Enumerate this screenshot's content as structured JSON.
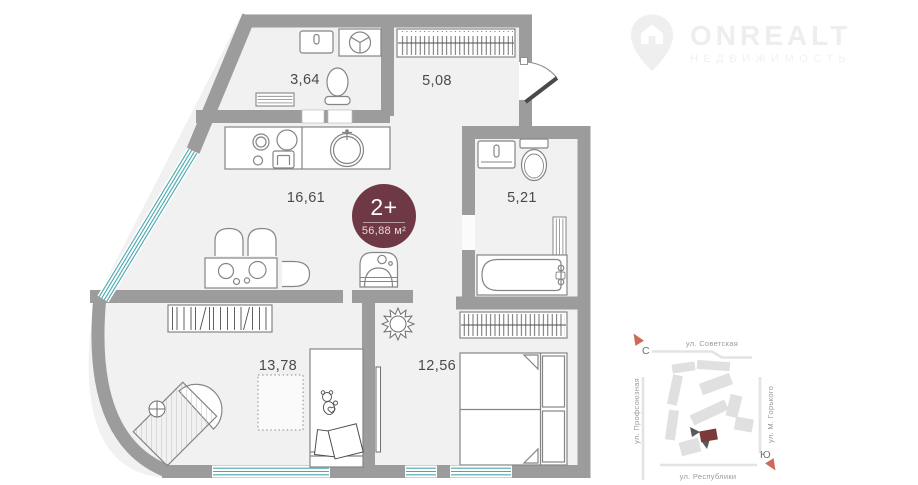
{
  "logo": {
    "title": "ONREALT",
    "subtitle": "НЕДВИЖИМОСТЬ",
    "icon": "house-pin-icon"
  },
  "plan": {
    "badge": {
      "rooms": "2+",
      "total_area": "56,88 м²"
    },
    "rooms": [
      {
        "id": "bathroom-small",
        "area": "3,64"
      },
      {
        "id": "hallway",
        "area": "5,08"
      },
      {
        "id": "kitchen-living",
        "area": "16,61"
      },
      {
        "id": "bathroom",
        "area": "5,21"
      },
      {
        "id": "kids-room",
        "area": "13,78"
      },
      {
        "id": "bedroom",
        "area": "12,56"
      }
    ]
  },
  "minimap": {
    "compass": {
      "north": "С",
      "south": "Ю"
    },
    "streets": {
      "top": "ул. Советская",
      "left": "ул. Профсоюзная",
      "right": "ул. М. Горького",
      "bottom": "ул. Республики"
    }
  },
  "colors": {
    "wall": "#9c9c9c",
    "floor": "#f1f1f1",
    "window_glass": "#4aa9af",
    "badge_bg": "#6e3944",
    "map_building": "#e0e0e0",
    "map_target_building": "#7b3a3a",
    "compass_arrow": "#cf6a57"
  }
}
